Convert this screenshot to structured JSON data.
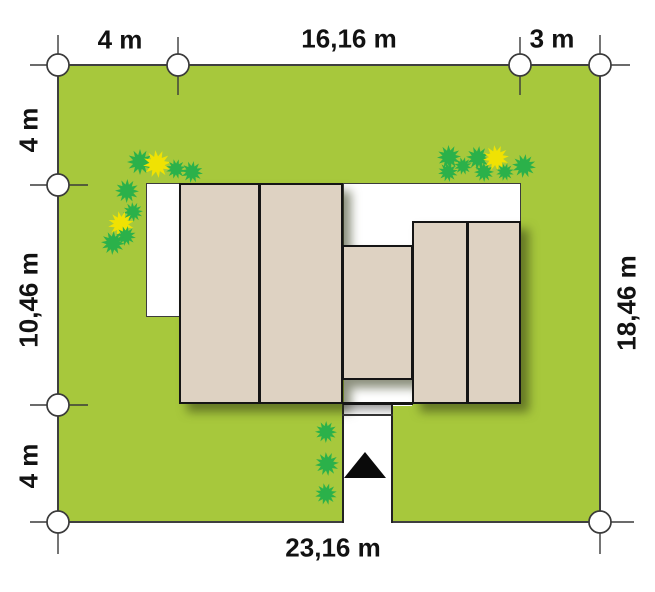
{
  "plan": {
    "type": "house-site-plan",
    "unit": "m"
  },
  "dimensions": {
    "top_setback_left": "4 m",
    "top_house_width": "16,16 m",
    "top_setback_right": "3 m",
    "left_setback_top": "4 m",
    "left_house_depth": "10,46 m",
    "left_setback_bottom": "4 m",
    "right_plot_depth": "18,46 m",
    "bottom_plot_width": "23,16 m"
  },
  "colors": {
    "grass": "#a7c83c",
    "roof": "#ded2c2",
    "outline": "#151515",
    "bush_green": "#2bb14a",
    "bush_yellow": "#f0e203",
    "paving": "#ffffff",
    "marker_stroke": "#3a3a3a"
  },
  "markers": {
    "circle_radius": 11,
    "circles": [
      [
        58,
        65
      ],
      [
        178,
        65
      ],
      [
        520,
        65
      ],
      [
        600,
        65
      ],
      [
        58,
        185
      ],
      [
        58,
        405
      ],
      [
        58,
        522
      ],
      [
        600,
        522
      ]
    ],
    "ticks": [
      [
        30,
        65,
        58,
        65
      ],
      [
        58,
        35,
        58,
        65
      ],
      [
        600,
        65,
        630,
        65
      ],
      [
        600,
        35,
        600,
        65
      ],
      [
        30,
        522,
        58,
        522
      ],
      [
        58,
        522,
        58,
        554
      ],
      [
        600,
        522,
        634,
        522
      ],
      [
        600,
        522,
        600,
        554
      ],
      [
        178,
        37,
        178,
        95
      ],
      [
        520,
        37,
        520,
        95
      ],
      [
        30,
        185,
        88,
        185
      ],
      [
        30,
        405,
        88,
        405
      ]
    ]
  },
  "vegetation": [
    [
      140,
      162,
      13,
      "g"
    ],
    [
      157,
      164,
      14,
      "y"
    ],
    [
      176,
      169,
      10,
      "g"
    ],
    [
      192,
      172,
      11,
      "g"
    ],
    [
      127,
      191,
      12,
      "g"
    ],
    [
      133,
      212,
      10,
      "g"
    ],
    [
      121,
      224,
      13,
      "y"
    ],
    [
      126,
      236,
      10,
      "g"
    ],
    [
      113,
      243,
      12,
      "g"
    ],
    [
      449,
      157,
      12,
      "g"
    ],
    [
      448,
      172,
      10,
      "g"
    ],
    [
      463,
      166,
      9,
      "g"
    ],
    [
      478,
      158,
      12,
      "g"
    ],
    [
      484,
      172,
      10,
      "g"
    ],
    [
      496,
      158,
      13,
      "y"
    ],
    [
      505,
      172,
      9,
      "g"
    ],
    [
      524,
      166,
      12,
      "g"
    ],
    [
      326,
      432,
      11,
      "g"
    ],
    [
      327,
      464,
      12,
      "g"
    ],
    [
      326,
      494,
      11,
      "g"
    ]
  ],
  "entrance_marker": {
    "shape": "triangle-up",
    "color": "#0a0a0a"
  }
}
